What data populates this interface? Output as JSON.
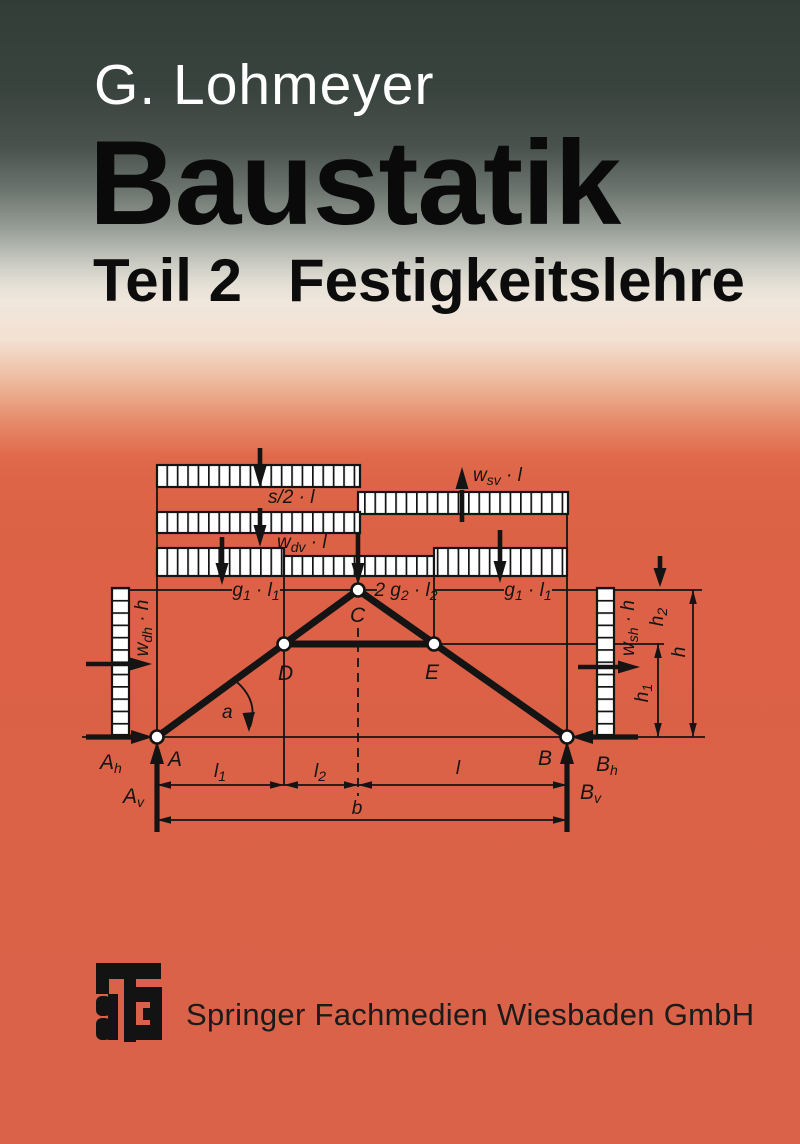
{
  "cover": {
    "author": "G. Lohmeyer",
    "title": "Baustatik",
    "subtitle": {
      "part": "Teil 2",
      "topic": "Festigkeitslehre"
    },
    "publisher": "Springer Fachmedien Wiesbaden GmbH",
    "logo_icon": "teubner-monogram-logo"
  },
  "colors": {
    "top_band": "#333d38",
    "cover_orange": "#dc6146",
    "bottom_orange": "#d96248",
    "ink": "#141414",
    "author_text": "#ffffff"
  },
  "diagram": {
    "load_labels": {
      "snow": "s/2 · l",
      "wind_sv": {
        "base": "w",
        "sub": "sv",
        "rest": " · l"
      },
      "wind_dv": {
        "base": "w",
        "sub": "dv",
        "rest": " · l"
      },
      "wind_dh": {
        "base": "w",
        "sub": "dh",
        "rest": " · h"
      },
      "wind_sh": {
        "base": "w",
        "sub": "sh",
        "rest": " · h"
      },
      "g1l1": {
        "p": "g",
        "s1": "1",
        "m": " · l",
        "s2": "1"
      },
      "g2l2": {
        "p": "2 g",
        "s1": "2",
        "m": " · l",
        "s2": "2"
      }
    },
    "nodes": {
      "a": "A",
      "b": "B",
      "c": "C",
      "d": "D",
      "e": "E"
    },
    "reactions": {
      "ah": {
        "base": "A",
        "sub": "h"
      },
      "av": {
        "base": "A",
        "sub": "v"
      },
      "bh": {
        "base": "B",
        "sub": "h"
      },
      "bv": {
        "base": "B",
        "sub": "v"
      }
    },
    "dims": {
      "l1": {
        "base": "l",
        "sub": "1"
      },
      "l2": {
        "base": "l",
        "sub": "2"
      },
      "l": "l",
      "b": "b",
      "h": "h",
      "h1": {
        "base": "h",
        "sub": "1"
      },
      "h2": {
        "base": "h",
        "sub": "2"
      },
      "alpha": "a"
    }
  }
}
